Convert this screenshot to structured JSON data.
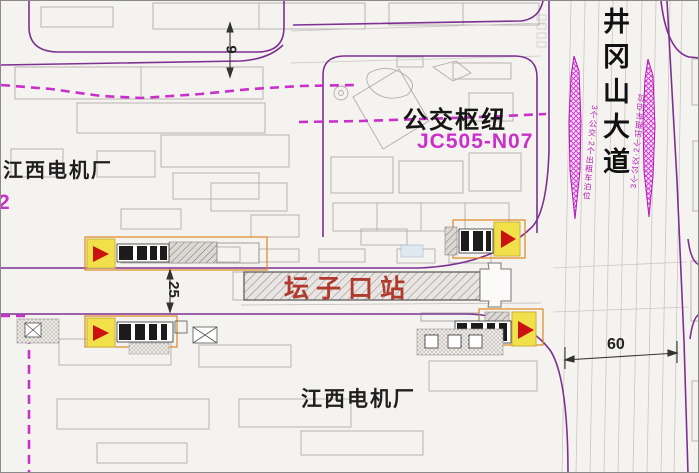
{
  "labels": {
    "factory_top": "江西电机厂",
    "factory_code_fragment": "2",
    "bus_hub": "公交枢纽",
    "parcel_code": "JC505-N07",
    "avenue": "井冈山大道",
    "station_name": "坛子口站",
    "factory_bottom": "江西电机厂",
    "bus_bay_left": "3个公交·2个出租车泊位",
    "bus_bay_right": "3个公交·2个出租车泊位"
  },
  "dimensions": {
    "top_street_width": "9",
    "station_road_width": "25",
    "avenue_width": "60"
  },
  "colors": {
    "road_edge_purple": "#7d3091",
    "planning_line_magenta": "#c92fc9",
    "bus_bay_magenta": "#d23bd2",
    "entrance_yellow": "#f1e04a",
    "entrance_arrow_red": "#cc1111",
    "entrance_outline_orange": "#e0861f",
    "station_label_red": "#b03a2e",
    "dimension_black": "#333333"
  }
}
